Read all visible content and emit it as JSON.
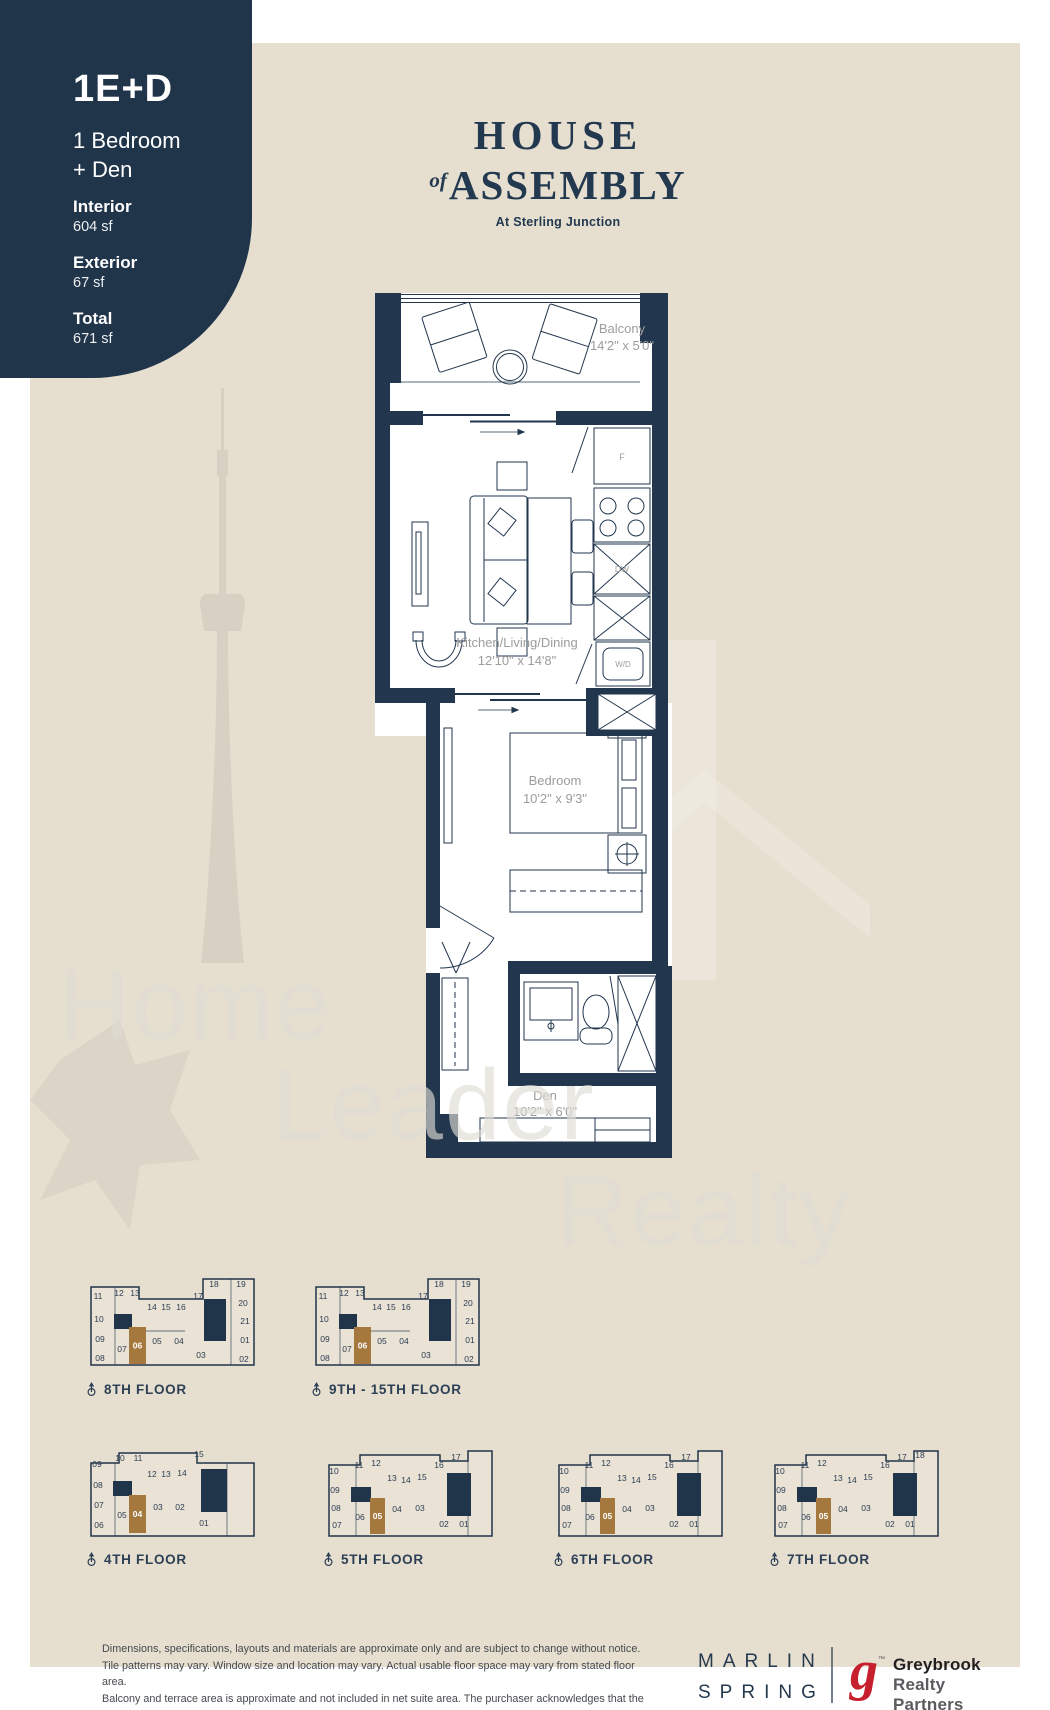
{
  "colors": {
    "navy": "#20344a",
    "beige": "#e6dfd0",
    "bronze": "#a5783e",
    "label_gray": "#9c9c9c",
    "red": "#c6202e"
  },
  "badge": {
    "code": "1E+D",
    "type_line1": "1 Bedroom",
    "type_line2": "+ Den",
    "stats": [
      {
        "label": "Interior",
        "value": "604 sf"
      },
      {
        "label": "Exterior",
        "value": "67 sf"
      },
      {
        "label": "Total",
        "value": "671 sf"
      }
    ]
  },
  "brand": {
    "line1": "HOUSE",
    "of": "of",
    "line2": "ASSEMBLY",
    "tagline": "At Sterling Junction"
  },
  "plan": {
    "balcony_name": "Balcony",
    "balcony_dims": "14'2\" x 5'0\"",
    "kld_name": "Kitchen/Living/Dining",
    "kld_dims": "12'10\" x 14'8\"",
    "bed_name": "Bedroom",
    "bed_dims": "10'2\" x 9'3\"",
    "den_name": "Den",
    "den_dims": "10'2\" x 6'0\"",
    "fridge": "F",
    "dw": "DW",
    "wd": "W/D"
  },
  "watermark": {
    "word1": "Home",
    "word2": "Leader",
    "word3": "Realty"
  },
  "keyplans": [
    {
      "label": "8TH FLOOR",
      "type": "A",
      "x": 85,
      "y": 1276,
      "hl": {
        "x": 44,
        "y": 51,
        "w": 17,
        "h": 37,
        "label": "06"
      },
      "cores": [
        [
          119,
          23,
          22,
          42
        ],
        [
          29,
          38,
          18,
          15
        ]
      ],
      "units": [
        [
          "11",
          13,
          20
        ],
        [
          "12",
          34,
          17
        ],
        [
          "13",
          50,
          17
        ],
        [
          "14",
          67,
          31
        ],
        [
          "15",
          81,
          31
        ],
        [
          "16",
          96,
          31
        ],
        [
          "17",
          113,
          20
        ],
        [
          "18",
          129,
          8
        ],
        [
          "19",
          156,
          8
        ],
        [
          "20",
          158,
          27
        ],
        [
          "21",
          160,
          45
        ],
        [
          "01",
          160,
          64
        ],
        [
          "02",
          159,
          83
        ],
        [
          "10",
          14,
          43
        ],
        [
          "09",
          15,
          63
        ],
        [
          "08",
          15,
          82
        ],
        [
          "07",
          37,
          73
        ],
        [
          "05",
          72,
          65
        ],
        [
          "04",
          94,
          65
        ],
        [
          "03",
          116,
          79
        ]
      ]
    },
    {
      "label": "9TH - 15TH FLOOR",
      "type": "A",
      "x": 310,
      "y": 1276,
      "hl": {
        "x": 44,
        "y": 51,
        "w": 17,
        "h": 37,
        "label": "06"
      },
      "cores": [
        [
          119,
          23,
          22,
          42
        ],
        [
          29,
          38,
          18,
          15
        ]
      ],
      "units": [
        [
          "11",
          13,
          20
        ],
        [
          "12",
          34,
          17
        ],
        [
          "13",
          50,
          17
        ],
        [
          "14",
          67,
          31
        ],
        [
          "15",
          81,
          31
        ],
        [
          "16",
          96,
          31
        ],
        [
          "17",
          113,
          20
        ],
        [
          "18",
          129,
          8
        ],
        [
          "19",
          156,
          8
        ],
        [
          "20",
          158,
          27
        ],
        [
          "21",
          160,
          45
        ],
        [
          "01",
          160,
          64
        ],
        [
          "02",
          159,
          83
        ],
        [
          "10",
          14,
          43
        ],
        [
          "09",
          15,
          63
        ],
        [
          "08",
          15,
          82
        ],
        [
          "07",
          37,
          73
        ],
        [
          "05",
          72,
          65
        ],
        [
          "04",
          94,
          65
        ],
        [
          "03",
          116,
          79
        ]
      ]
    },
    {
      "label": "4TH FLOOR",
      "type": "B",
      "x": 85,
      "y": 1446,
      "hl": {
        "x": 44,
        "y": 49,
        "w": 17,
        "h": 38,
        "label": "04"
      },
      "cores": [
        [
          116,
          23,
          26,
          43
        ],
        [
          28,
          35,
          19,
          15
        ]
      ],
      "units": [
        [
          "09",
          12,
          18
        ],
        [
          "10",
          35,
          12
        ],
        [
          "11",
          53,
          12
        ],
        [
          "12",
          67,
          28
        ],
        [
          "13",
          81,
          28
        ],
        [
          "14",
          97,
          27
        ],
        [
          "15",
          114,
          8
        ],
        [
          "08",
          13,
          39
        ],
        [
          "07",
          14,
          59
        ],
        [
          "06",
          14,
          79
        ],
        [
          "05",
          37,
          69
        ],
        [
          "03",
          73,
          61
        ],
        [
          "02",
          95,
          61
        ],
        [
          "01",
          119,
          77
        ]
      ]
    },
    {
      "label": "5TH FLOOR",
      "type": "C",
      "x": 322,
      "y": 1446,
      "hl": {
        "x": 48,
        "y": 52,
        "w": 15,
        "h": 36,
        "label": "05"
      },
      "cores": [
        [
          125,
          27,
          24,
          43
        ],
        [
          29,
          41,
          20,
          15
        ]
      ],
      "units": [
        [
          "10",
          12,
          25
        ],
        [
          "11",
          37,
          19
        ],
        [
          "12",
          54,
          17
        ],
        [
          "13",
          70,
          32
        ],
        [
          "14",
          84,
          34
        ],
        [
          "15",
          100,
          31
        ],
        [
          "16",
          117,
          19
        ],
        [
          "17",
          134,
          11
        ],
        [
          "09",
          13,
          44
        ],
        [
          "08",
          14,
          62
        ],
        [
          "07",
          15,
          79
        ],
        [
          "06",
          38,
          71
        ],
        [
          "04",
          75,
          63
        ],
        [
          "03",
          98,
          62
        ],
        [
          "02",
          122,
          78
        ],
        [
          "01",
          142,
          78
        ]
      ]
    },
    {
      "label": "6TH FLOOR",
      "type": "C",
      "x": 552,
      "y": 1446,
      "hl": {
        "x": 48,
        "y": 52,
        "w": 15,
        "h": 36,
        "label": "05"
      },
      "cores": [
        [
          125,
          27,
          24,
          43
        ],
        [
          29,
          41,
          20,
          15
        ]
      ],
      "units": [
        [
          "10",
          12,
          25
        ],
        [
          "11",
          37,
          19
        ],
        [
          "12",
          54,
          17
        ],
        [
          "13",
          70,
          32
        ],
        [
          "14",
          84,
          34
        ],
        [
          "15",
          100,
          31
        ],
        [
          "16",
          117,
          19
        ],
        [
          "17",
          134,
          11
        ],
        [
          "09",
          13,
          44
        ],
        [
          "08",
          14,
          62
        ],
        [
          "07",
          15,
          79
        ],
        [
          "06",
          38,
          71
        ],
        [
          "04",
          75,
          63
        ],
        [
          "03",
          98,
          62
        ],
        [
          "02",
          122,
          78
        ],
        [
          "01",
          142,
          78
        ]
      ]
    },
    {
      "label": "7TH FLOOR",
      "type": "C",
      "x": 768,
      "y": 1446,
      "hl": {
        "x": 48,
        "y": 52,
        "w": 15,
        "h": 36,
        "label": "05"
      },
      "cores": [
        [
          125,
          27,
          24,
          43
        ],
        [
          29,
          41,
          20,
          15
        ]
      ],
      "units": [
        [
          "10",
          12,
          25
        ],
        [
          "11",
          37,
          19
        ],
        [
          "12",
          54,
          17
        ],
        [
          "13",
          70,
          32
        ],
        [
          "14",
          84,
          34
        ],
        [
          "15",
          100,
          31
        ],
        [
          "16",
          117,
          19
        ],
        [
          "17",
          134,
          11
        ],
        [
          "18",
          152,
          9
        ],
        [
          "09",
          13,
          44
        ],
        [
          "08",
          14,
          62
        ],
        [
          "07",
          15,
          79
        ],
        [
          "06",
          38,
          71
        ],
        [
          "04",
          75,
          63
        ],
        [
          "03",
          98,
          62
        ],
        [
          "02",
          122,
          78
        ],
        [
          "01",
          142,
          78
        ]
      ]
    }
  ],
  "disclaimer_lines": [
    "Dimensions, specifications, layouts and materials are approximate only and are subject to change without notice.",
    "Tile patterns may vary. Window size and location may vary. Actual usable floor space may vary from stated floor area.",
    "Balcony and terrace area is approximate and not included in net suite area. The purchaser acknowledges that the",
    "actual unit purchased may be a reverse layout to the plan shown. See Sales Representative for full details. E.&O.E."
  ],
  "footer": {
    "marlin_line1": "MARLIN",
    "marlin_line2": "SPRING",
    "grey_g": "g",
    "grey_tm": "™",
    "grey_name": "Greybrook",
    "grey_sub": "Realty Partners"
  }
}
